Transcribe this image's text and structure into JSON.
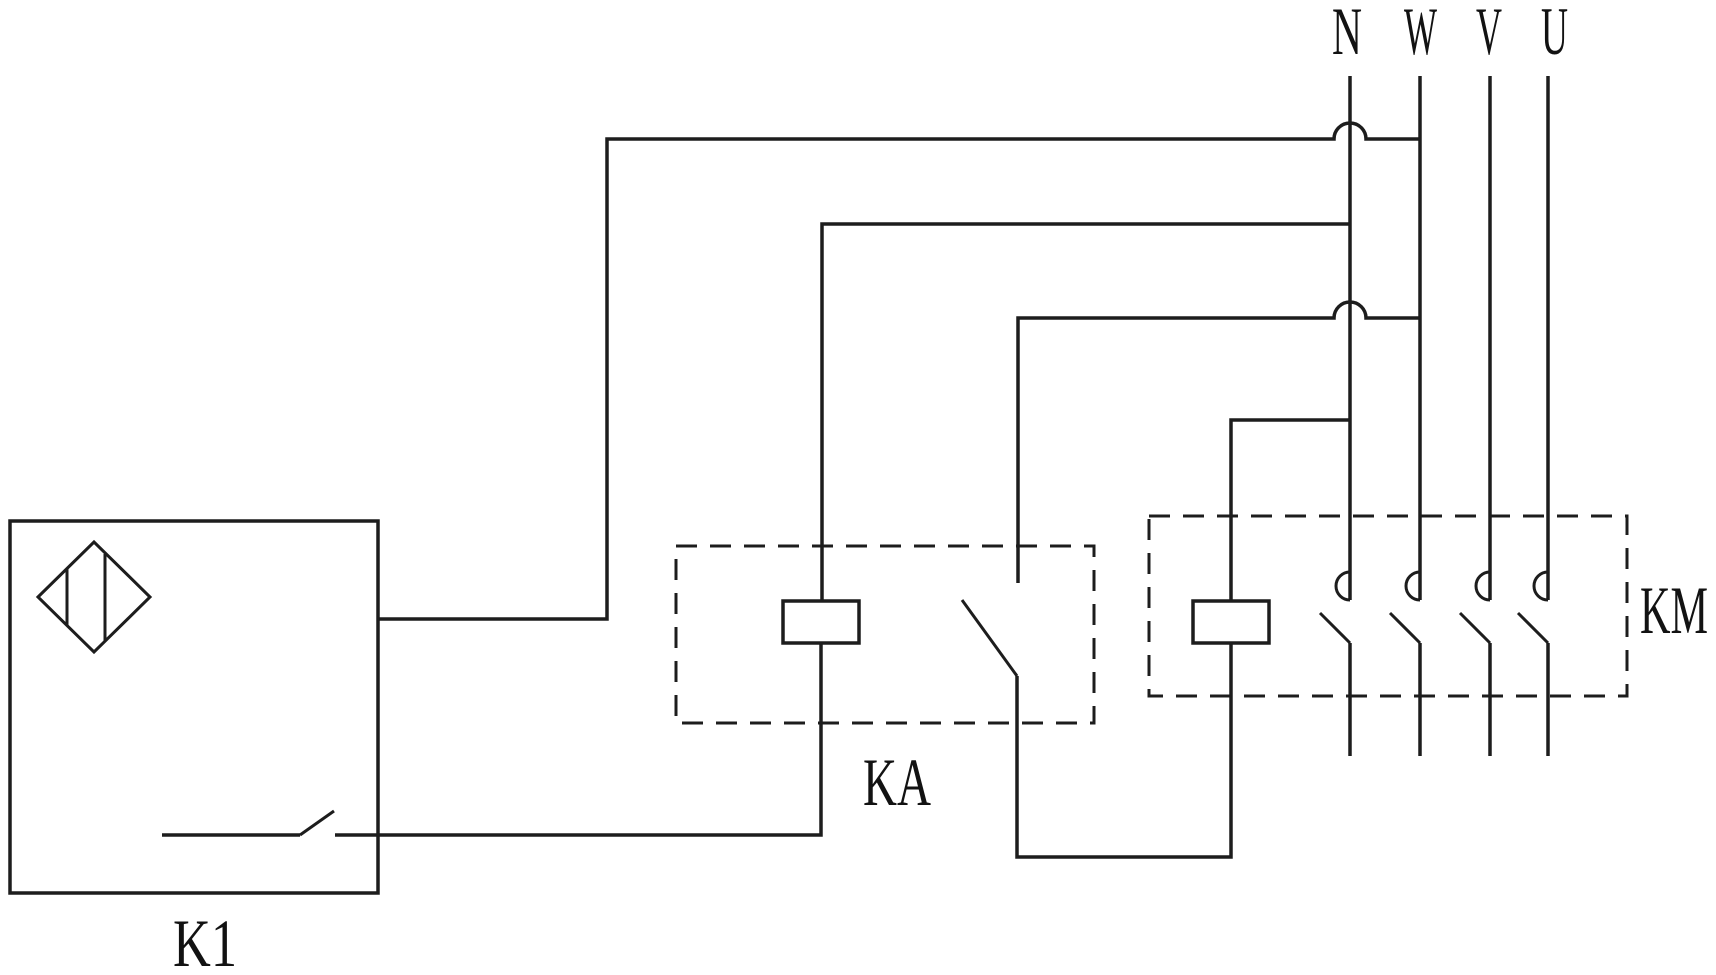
{
  "colors": {
    "background": "#ffffff",
    "line": "#1d1d1d",
    "text": "#121212"
  },
  "power_bus": {
    "labels": [
      "N",
      "W",
      "V",
      "U"
    ]
  },
  "components": {
    "k1_label": "K1",
    "ka_label": "KA",
    "km_label": "KM"
  }
}
